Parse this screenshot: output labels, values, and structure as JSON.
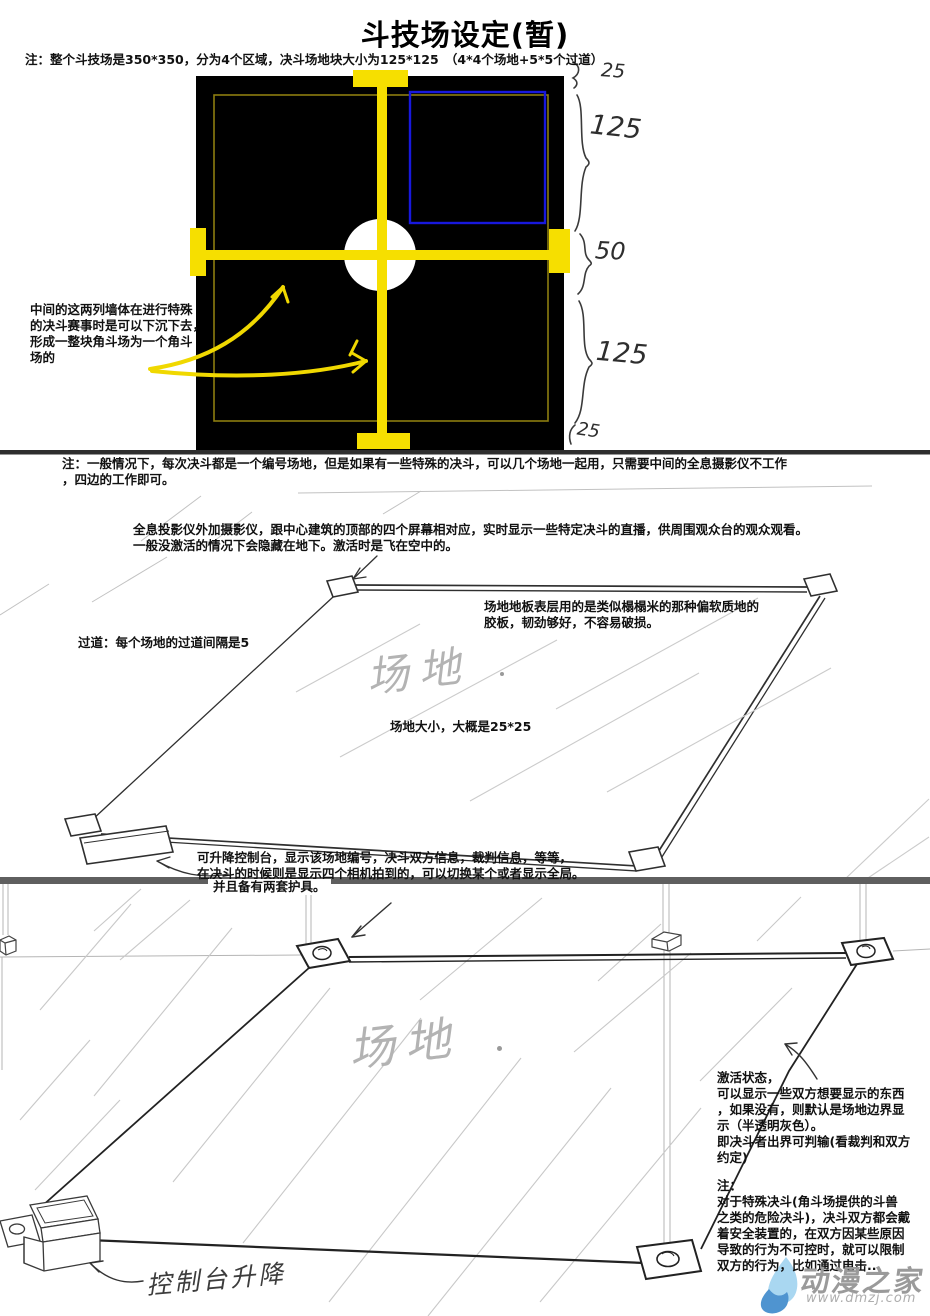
{
  "page": {
    "title": "斗技场设定(暂)",
    "top_note": "注：整个斗技场是350*350，分为4个区域，决斗场地块大小为125*125　（4*4个场地+5*5个过道）"
  },
  "arena": {
    "wall_note": "中间的这两列墙体在进行特殊\n的决斗赛事时是可以下沉下去，\n形成一整块角斗场为一个角斗\n场的",
    "dims": [
      "25",
      "125",
      "50",
      "125",
      "25"
    ],
    "colors": {
      "wall_yellow": "#f6df00",
      "zone_blue": "#1818dd",
      "floor_black": "#000000",
      "hologram_white": "#ffffff"
    }
  },
  "mid": {
    "general_note": "注：一般情况下，每次决斗都是一个编号场地，但是如果有一些特殊的决斗，可以几个场地一起用，只需要中间的全息摄影仪不工作\n，四边的工作即可。",
    "holo_note": "全息投影仪外加摄影仪，跟中心建筑的顶部的四个屏幕相对应，实时显示一些特定决斗的直播，供周围观众台的观众观看。\n一般没激活的情况下会隐藏在地下。激活时是飞在空中的。",
    "aisle_note": "过道：每个场地的过道间隔是5",
    "floor_note": "场地地板表层用的是类似榻榻米的那种偏软质地的\n胶板，韧劲够好，不容易破损。",
    "field_label": "场地",
    "size_note": "场地大小，大概是25*25",
    "console_note": "可升降控制台，显示该场地编号，决斗双方信息，裁判信息，等等，\n在决斗的时候则是显示四个相机拍到的，可以切换某个或者显示全局。",
    "console_note2": "并且备有两套护具。"
  },
  "bottom": {
    "field_label": "场地",
    "activation_note": "激活状态，\n可以显示一些双方想要显示的东西\n，如果没有，则默认是场地边界显\n示（半透明灰色）。\n即决斗者出界可判输(看裁判和双方\n约定)",
    "special_note": "注：\n对于特殊决斗(角斗场提供的斗兽\n之类的危险决斗)，决斗双方都会戴\n着安全装置的，在双方因某些原因\n导致的行为不可控时，就可以限制\n双方的行为，比如通过电击..",
    "console_scribble": "控制台升降"
  },
  "watermark": {
    "name": "动漫之家",
    "url": "www.dmzj.com"
  }
}
